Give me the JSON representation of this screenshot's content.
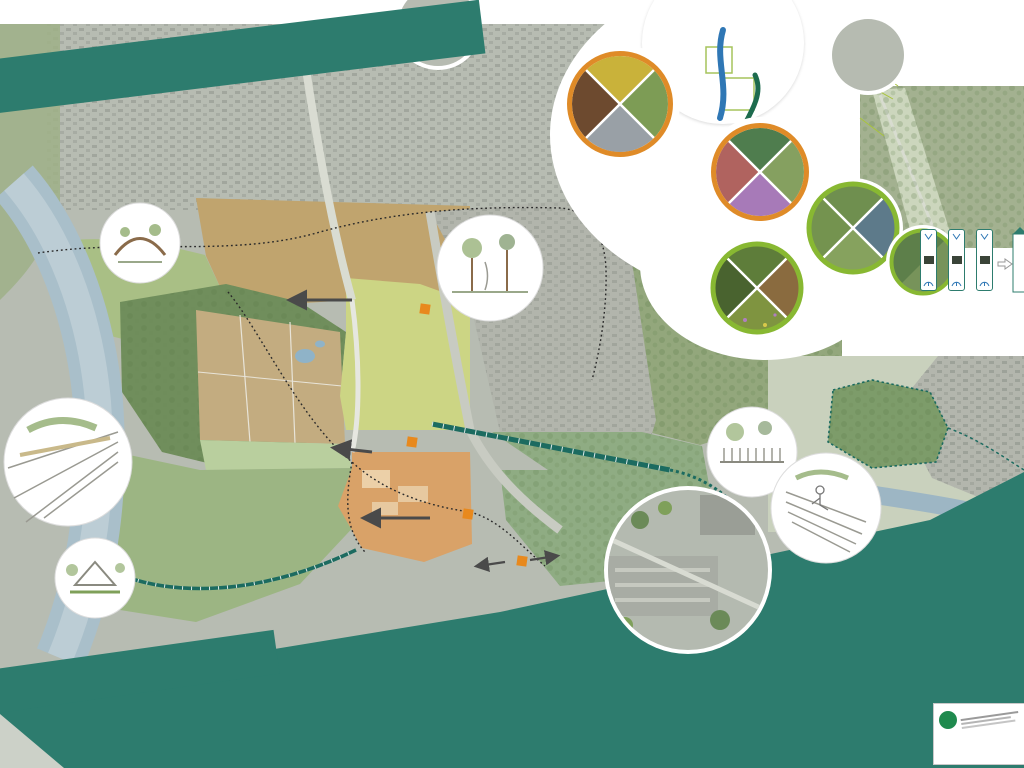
{
  "poster": {
    "title_banner": "STRUKTURKONZEPT RUHRPARK",
    "bottom_banner": "ERLEBNISLABORE"
  },
  "sections": {
    "erleben_header": "ERLEBEN",
    "informieren_header": "INFORMIEREN",
    "informieren_caption": "Merkpfosten informieren entlang des Erlebnisweges Landschaft über Themen aus den Blickwinkeln der Ökologie, der Geschichte und der Identität."
  },
  "park_legend": {
    "der_park": {
      "title": "Der Park",
      "items": "Alltag\nGestern\nMorgen"
    },
    "erleben": {
      "title": "Erleben",
      "items": "Erkunden\nEntdecken\nLernen\nSpielen"
    },
    "ruhr": {
      "title": "Ruhr",
      "items": "Natur\nLandschaft\nÖkologie"
    }
  },
  "photo_circles": {
    "c1": "WAHRNEHMBARKEIT IM STADTTEIL",
    "c2": "SOZIALE BELEBUNG",
    "c3": "BIODIVERSITÄT"
  },
  "map": {
    "area_labels": [
      {
        "n": "1",
        "t": "Erlebnislabor\nRuhr",
        "x": 42,
        "y": 330,
        "ns": "l"
      },
      {
        "n": "3",
        "t": "Erlebnislabor\nWiese",
        "x": 82,
        "y": 272,
        "ns": "r"
      },
      {
        "n": "4",
        "t": "Erlebnislabor\nAltholzbestand",
        "x": 170,
        "y": 309,
        "ns": "r"
      },
      {
        "n": "10",
        "t": "Erlebnislabor\nParkimpulse",
        "x": 285,
        "y": 232,
        "ns": "r"
      },
      {
        "n": "5",
        "t": "Erlebnislabor\nNaturspiel",
        "x": 350,
        "y": 372,
        "ns": "r"
      },
      {
        "n": "7",
        "t": "Erlebnislabor\nMobilität",
        "x": 448,
        "y": 374,
        "ns": "l"
      },
      {
        "n": "2",
        "t": "Erlebnislabor\nRuhrteich",
        "x": 268,
        "y": 452,
        "ns": "r"
      },
      {
        "n": "8",
        "t": "Erlebnislabor\nSolbadhalde",
        "x": 575,
        "y": 474,
        "ns": "r"
      },
      {
        "n": "6",
        "t": "Erlebnislabor\nSport und Bewegung",
        "x": 438,
        "y": 554,
        "ns": "l"
      },
      {
        "n": "9",
        "t": "Erlebnislabor\nFeuchtgebiet\nHalde Alstaden",
        "x": 845,
        "y": 411,
        "ns": "l"
      },
      {
        "n": "1",
        "t": "Erlebnislabor\nRuhr",
        "x": 888,
        "y": 484,
        "ns": "r"
      }
    ],
    "point_labels": [
      {
        "t": "Streuobst",
        "x": 64,
        "y": 259,
        "s": "r"
      },
      {
        "t": "Freiluftklasse",
        "x": 110,
        "y": 287,
        "s": "r"
      },
      {
        "t": "Erhalt Teehaus",
        "x": 192,
        "y": 289,
        "s": "l"
      },
      {
        "t": "Nistkästen Fledermaus",
        "x": 164,
        "y": 329,
        "s": "r"
      },
      {
        "t": "Wildwiese",
        "x": 192,
        "y": 357,
        "s": "r"
      },
      {
        "t": "Nachpflanzung klimaangepasster Einzelbäume",
        "x": 160,
        "y": 386,
        "s": "l"
      },
      {
        "t": "Wildwiese",
        "x": 143,
        "y": 438,
        "s": "r"
      },
      {
        "t": "Entschlammen und Entkusseln",
        "x": 302,
        "y": 469,
        "s": "r"
      },
      {
        "t": "Beobachtungssteg",
        "x": 158,
        "y": 500,
        "s": "r"
      },
      {
        "t": "Zugang Ruhr",
        "x": 152,
        "y": 527,
        "s": "r"
      },
      {
        "t": "Nachpflanzung Einzelbäume Platanen-Allee",
        "x": 227,
        "y": 198,
        "s": "l"
      },
      {
        "t": "Tribüne Jahnwiese",
        "x": 296,
        "y": 259,
        "s": "l"
      },
      {
        "t": "Bühne",
        "x": 308,
        "y": 272,
        "s": "l"
      },
      {
        "t": "Nachpflanzung klimaangepasster Einzelbäume",
        "x": 227,
        "y": 308,
        "s": "l"
      },
      {
        "t": "Temporäre Aufstellfläche",
        "x": 350,
        "y": 322,
        "s": "r"
      },
      {
        "t": "Regenwasserabkopplung",
        "x": 390,
        "y": 295,
        "s": "n"
      },
      {
        "t": "Fußgängerüberweg",
        "x": 433,
        "y": 317,
        "s": "l"
      },
      {
        "t": "Regenwasserspielplatz",
        "x": 382,
        "y": 328,
        "s": "l"
      },
      {
        "t": "Spielgebüsch",
        "x": 386,
        "y": 344,
        "s": "l"
      },
      {
        "t": "Picknickwiese",
        "x": 287,
        "y": 341,
        "s": "r"
      },
      {
        "t": "Wasserwald",
        "x": 297,
        "y": 351,
        "s": "r"
      },
      {
        "t": "Slacklinebänke",
        "x": 230,
        "y": 355,
        "s": "l"
      },
      {
        "t": "Liegebänke",
        "x": 255,
        "y": 367,
        "s": "l"
      },
      {
        "t": "U3 Angebote",
        "x": 435,
        "y": 414,
        "s": "r"
      },
      {
        "t": "Kleinspielfeld",
        "x": 387,
        "y": 467,
        "s": "l"
      },
      {
        "t": "Geländemodifizierung durch Stufen",
        "x": 404,
        "y": 484,
        "s": "l"
      },
      {
        "t": "Prüfung Umnutzung Gebäude",
        "x": 450,
        "y": 498,
        "s": "l"
      },
      {
        "t": "Calisthenics",
        "x": 381,
        "y": 508,
        "s": "r"
      },
      {
        "t": "Streetball 3x3",
        "x": 417,
        "y": 507,
        "s": "l"
      },
      {
        "t": "Fußgängerüberweg",
        "x": 483,
        "y": 513,
        "s": "l"
      },
      {
        "t": "Aussichtspunkt",
        "x": 551,
        "y": 443,
        "s": "l"
      },
      {
        "t": "Beobachtungssteg",
        "x": 876,
        "y": 402,
        "s": "l"
      },
      {
        "t": "Beobachtungs-\npunkt Kolk",
        "x": 800,
        "y": 442,
        "s": "l",
        "w": 42
      },
      {
        "t": "Umgestaltung\nPanorama Rastplatz",
        "x": 877,
        "y": 438,
        "s": "l",
        "w": 50
      },
      {
        "t": "Prüfung Verlauf\nRuhrtalradweg",
        "x": 955,
        "y": 451,
        "s": "n",
        "w": 46
      },
      {
        "t": "Pflegearbeiten Ruhrwiesen\n(Herkulesstaude)",
        "x": 862,
        "y": 460,
        "s": "n",
        "w": 72
      },
      {
        "t": "Sitzstufen Deich",
        "x": 922,
        "y": 467,
        "s": "l"
      }
    ],
    "path_labels": [
      {
        "t": "RUHRTALRADWEG",
        "x": 100,
        "y": 270,
        "r": -68,
        "c": "#1c6b60"
      },
      {
        "t": "ERLEBNISWEG RUHRPARK",
        "x": 186,
        "y": 577,
        "r": -7,
        "c": "#ffffff"
      },
      {
        "t": "Straßenunabhängiger Gehweg",
        "x": 403,
        "y": 392,
        "r": -86,
        "c": "#6a6a6a"
      },
      {
        "t": "Chaussee 'Parkstraße Solbadhalde'",
        "x": 540,
        "y": 443,
        "r": 11,
        "c": "#ffffff"
      }
    ]
  },
  "erleben_map": {
    "labels": [
      {
        "t": "Feuchtbiotop",
        "x": 846,
        "y": 24
      },
      {
        "t": "Blühhügel",
        "x": 845,
        "y": 67
      },
      {
        "t": "Energiewirtschaft",
        "x": 855,
        "y": 124
      },
      {
        "t": "Ruhrwiesen",
        "x": 879,
        "y": 71
      },
      {
        "t": "Birnbaum",
        "x": 926,
        "y": 47
      },
      {
        "t": "Platanen-Allee",
        "x": 989,
        "y": 42
      },
      {
        "t": "Insektenwelt",
        "x": 953,
        "y": 61
      },
      {
        "t": "Bodendenkmal",
        "x": 1001,
        "y": 68
      },
      {
        "t": "Höhlenquartier",
        "x": 941,
        "y": 77
      },
      {
        "t": "Altholzbestände",
        "x": 904,
        "y": 85
      },
      {
        "t": "Fledermäuse",
        "x": 954,
        "y": 90
      },
      {
        "t": "Wilde Wiese",
        "x": 916,
        "y": 112
      },
      {
        "t": "Unter freiem\nHimmel",
        "x": 976,
        "y": 112
      },
      {
        "t": "Mammutbaum",
        "x": 950,
        "y": 128
      },
      {
        "t": "Feuchtbiotop",
        "x": 1002,
        "y": 130
      },
      {
        "t": "Ruhr",
        "x": 905,
        "y": 138
      },
      {
        "t": "Grünlandnutzung",
        "x": 893,
        "y": 164
      },
      {
        "t": "Mistelbaum",
        "x": 958,
        "y": 164
      }
    ]
  },
  "panel": {
    "columns": [
      {
        "num": "1",
        "title": "Erlebnislabor Ruhr",
        "x": 63,
        "y": 686,
        "w": 152,
        "bullets": [
          "Ruhrterrassen (Stufen- und Rampenanlagen im Deich mit Blick auf Ruhr und die Energielandschaft)",
          "Wiederaufleben der Beweidung mit Schafen auf den Ruhrwiesen",
          "Umgestaltung Panorama-Rastplatz",
          "Vogelbeobachtungsplatz am Kolk"
        ]
      },
      {
        "num": "2",
        "title": "Erlebnislabor Ruhrteich",
        "x": 218,
        "y": 666,
        "w": 134,
        "bullets": [
          "Ökologische Optimierung (Entschlammen und Entkusseln des Gewässers)",
          "Erhalt eines bewachsenen Gehölzstreifens am Rand zum Schutz vor ungewolltem Betreten",
          "Errichtung eines Beobachtungssteges in Verlängerung der Ruhrtreppe",
          "Ergänzende Informationsangebote zu Tier- und Pflanzenwelt sowie Zusammenhang zwischen Wasserstand und Grundwasser"
        ]
      },
      {
        "num": "3",
        "title": "Erlebnislabor Wiese",
        "x": 352,
        "y": 652,
        "w": 147,
        "bullets": [
          "Ökologische Anreicherung und Erhöhung von Strukturreichtum und der Biodiversität",
          "Kleinflächig eingestreute Einsaatinseln mit Kräutern und Regiosaatgut UG 2",
          "Differenzierte Mahdintensitäten",
          "Kooperation mit z. B. Biostation oder Naturschutzverbänden",
          "Anpflanzen von Streuobst und punktuell Beerenobst",
          "Grünes Klassenzimmer als außerschulischer Lernort",
          "Potentialfläche für Imker mit Bienenstöcken oder mögliche Urban Gardening Initiative"
        ]
      },
      {
        "num": "4",
        "title": "Erlebnislabor Altholzbestand",
        "x": 500,
        "y": 610,
        "w": 152,
        "bullets": [
          "Schutz und Inwertsetzung des Altholzbestandes",
          "Schließung des Trampelpfades durch Nachpflanzungen",
          "Erhalt und Entwicklung ökologisch wertvoller Totholzbestände",
          "Anbringen von Nisthilfen für Fledermäuse",
          "Ergänzende Umweltbildungsangebote (z.B. aufklappbare Spechthöhle, Tastbare Pilze, Audioinformation zu Vogelgeräuschen)"
        ]
      },
      {
        "num": "5",
        "title": "Erlebnislabor Naturspiel",
        "x": 500,
        "y": 702,
        "w": 152,
        "bullets": [
          "Erweiterung der Spielfläche durch Entwicklung eines Spielgebüsches mit Kletter- und Balancierelementen durchs Unterholz",
          "Regenwasserspielplatz (Abkopplung von Dachflächenwasser und Einspeisung in modellierte Mulden und Gräben",
          "ergänzende U3 Angebote auf dem Spielplatz"
        ]
      },
      {
        "num": "6",
        "title": "Erlebnislabor Sport und Bewegung",
        "x": 650,
        "y": 658,
        "w": 158,
        "bullets": [
          "Einbindung der ehemaligen Sportplatzfläche in den Ruhrpark durch Öffnung des Zauns und Abtreppen des Geländes",
          "Ergänzende Sportangebote wie z.B. Kleinspielfeld, Calisthenics und Streetball 3x3",
          "Platz für Veranstaltungen wie Flohmärkte oder MTB Fest",
          "Berücksichtigung der Gebäudenutzung durch den Radsportverein",
          "Prüfung zur Umnutzung Gebäudebestand (z.B. gastronomisch, Nutzung der vorh. Toilettenanlagen für die Öffentlichkeit)"
        ]
      },
      {
        "num": "7",
        "title": "Erlebnislabor Mobilität",
        "x": 778,
        "y": 560,
        "w": 154,
        "bullets": [
          "Optische und funktionale Verbindung von Ruhrpark und Solbadhalde über die Solbadstraße hinweg",
          "Entwicklung eines Verkehrsraumes für zukunftsgerichtete Mobilität",
          "Entwicklung zur Fahrradstraße",
          "Schaffung von Überquerungsmöglichkeiten, z.B. Zebrastreifen",
          "Anlage eines straßenunabhängigen Fußweges im Ruhrpark",
          "Neustrukturierung Parksituation (Parkstreifen oder Parkbuchten)",
          "Berücksichtigung von Mobilitätsstationen durch Ladeboxen für E-Autos",
          "Fahrradstellplätze und Ladestation im gesamten Planungsraum"
        ]
      },
      {
        "num": "8",
        "title": "Erlebnislabor Solbadhalde",
        "x": 778,
        "y": 690,
        "w": 154,
        "bullets": [
          "Öffnung und Gestaltung der Zugangssituation",
          "Freischneiden einer Sichtachse vom Hochpunkt aus zum Ruhrpark",
          "Bewirtschaftung der Blickachse als Kurzumtriebsplantage",
          "Errichten einer kleinen Aussichtskanzel",
          "Ertüchtigung der Wege",
          "Versuchsflächen Tiny Forests"
        ]
      },
      {
        "num": "9",
        "title": "Erlebnislabor Feuchtgebiet",
        "x": 936,
        "y": 516,
        "w": 122,
        "bullets": [
          "Ökologische Optimierung durch wasserrechtliche und landschaftsplanerische Maßnahmen",
          "Nistangebote für gefährdete Arten",
          "Bau eines Beobachtungssteges mit Beobachtungswand inkl. Informationstafeln",
          "Abstimmung und Beteiligung mit den örtlichen Bildungsträgern und Vereinen"
        ]
      },
      {
        "num": "10",
        "title": "Erlebnislabor Parkimpulse",
        "x": 936,
        "y": 600,
        "w": 122,
        "bullets": [
          "Errichtung einer Bühne auf Damm",
          "Sitzsteine in Damm als Tribüne zur Jahnwiese (Fußball, Schulklassen)",
          "Ergänzende Ausstattung auf Flächen (Slackline-Bänke, Liege- und Sitzbänke, Abfallbehälter)",
          "Innovative Ausstattungselemente (z.B. von Sitzbänken, Solargrills)",
          "Rasenfläche für Picknick und Spiel (Sport im Park, Frisbee, ...)",
          "Vorhaltung einer standfesten Fläche als temporäre Aufstellfläche für z.B. Food Trucks, Verkaufsstände"
        ]
      }
    ]
  },
  "title_block": {
    "title": "Strukturkonzept Ruhrpark",
    "date": "16.12.2021",
    "client_label": "Auftragnehmer:"
  },
  "colors": {
    "teal": "#2d7c6e",
    "header_green": "#0f8a52",
    "orange_ring": "#df8b28",
    "green_ring": "#88b832",
    "lime": "#a9c43c",
    "path_teal": "#1c6b60",
    "river": "#a9bfca",
    "crossing_orange": "#e8891d"
  }
}
